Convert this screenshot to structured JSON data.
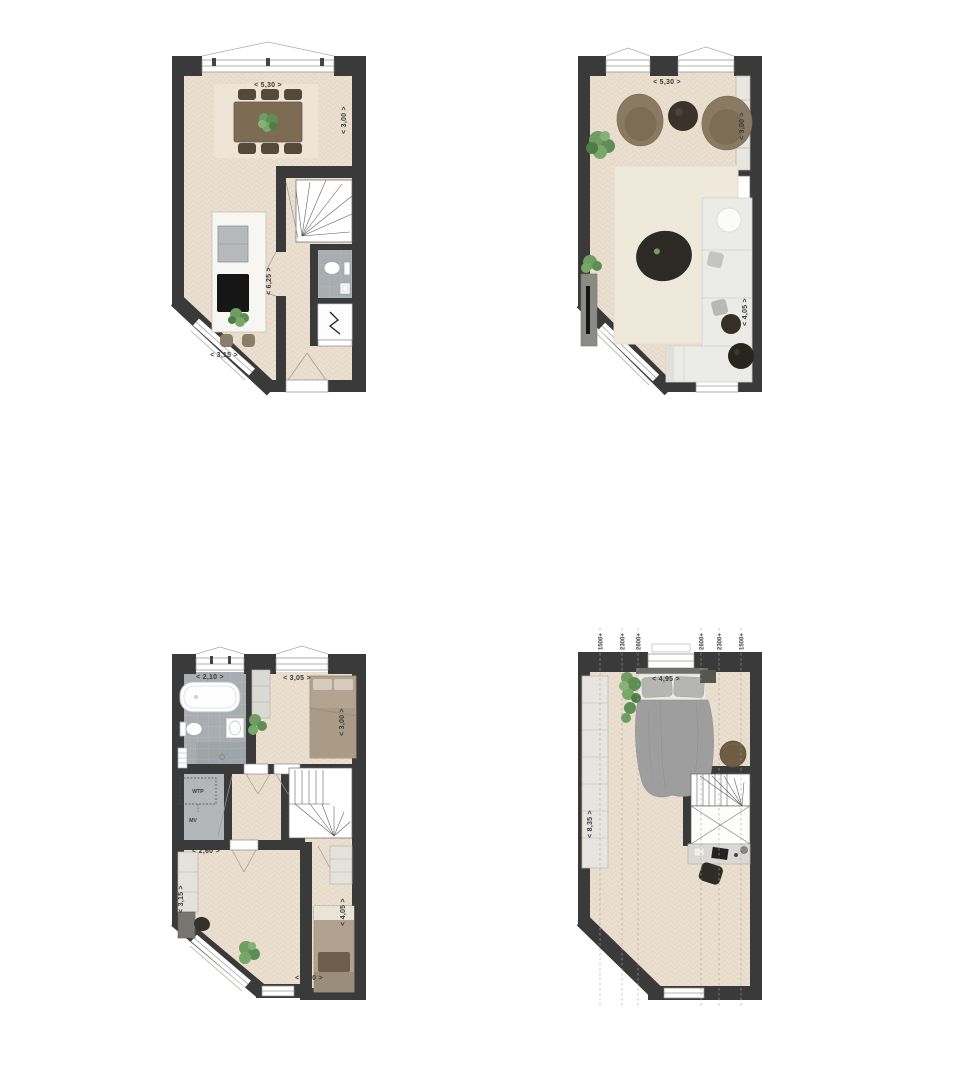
{
  "page": {
    "background": "#ffffff",
    "type": "floor-plan-sheet",
    "plan_count": 4
  },
  "colors": {
    "wall": "#3a3a3a",
    "floor": "#ebdfd0",
    "floor_line": "#dccdb9",
    "tile": "#a7adb0",
    "rug": "#efe9dc",
    "marble": "#f7f6f3",
    "plant_green": "#6f9d62",
    "wood_brown": "#7d6b53",
    "dark_furniture": "#35322d",
    "duvet_gray": "#9e9e9e",
    "cabinet_light": "#e7e5e0",
    "bed_taupe": "#b3a491"
  },
  "plans": [
    {
      "id": "top-left",
      "labels": {
        "top": "< 5,30 >",
        "right": "< 3,00 >",
        "left": "< 8,35 >",
        "hall": "< 6,25 >",
        "bottom": "< 3,15 >"
      },
      "features": [
        "dining-table",
        "dining-chairs",
        "plant",
        "kitchen-island",
        "sink",
        "cooktop",
        "bar-stools",
        "winder-staircase",
        "toilet",
        "washbasin",
        "meter-cupboard",
        "entrance-door",
        "windows"
      ]
    },
    {
      "id": "top-right",
      "labels": {
        "top": "< 5,30 >",
        "right_upper": "< 3,00 >",
        "left": "< 8,35 >",
        "right_lower": "< 4,05 >"
      },
      "features": [
        "armchairs",
        "round-side-table",
        "plant",
        "wall-cabinet",
        "winder-staircase",
        "rug",
        "coffee-table",
        "corner-sofa",
        "side-tables",
        "tv-sideboard",
        "windows"
      ]
    },
    {
      "id": "bottom-left",
      "labels": {
        "bath": "< 2,10 >",
        "bed1_w": "< 3,05 >",
        "bed1_d": "< 3,00 >",
        "bed3_w": "< 2,60 >",
        "bed3_d": "< 3,15 >",
        "bed2_d": "< 4,05 >",
        "bed2_w": "< 2,60 >",
        "wtp": "WTP",
        "mv": "MV"
      },
      "features": [
        "bathtub",
        "toilet",
        "washbasin",
        "radiator",
        "shower-zone",
        "wardrobe",
        "bed",
        "plant",
        "technical-closet",
        "winder-staircase",
        "desk",
        "desk-chair",
        "second-bed",
        "windows"
      ]
    },
    {
      "id": "bottom-right",
      "height_lines": [
        "1500+",
        "2300+",
        "2600+",
        "2600+",
        "2300+",
        "1500+"
      ],
      "labels": {
        "bed_w": "< 4,95 >",
        "left": "< 8,35 >"
      },
      "features": [
        "wardrobe",
        "bed",
        "plant",
        "nightstand",
        "pouf",
        "winder-staircase",
        "roof-opening",
        "desk",
        "desk-chair",
        "windows"
      ]
    }
  ]
}
